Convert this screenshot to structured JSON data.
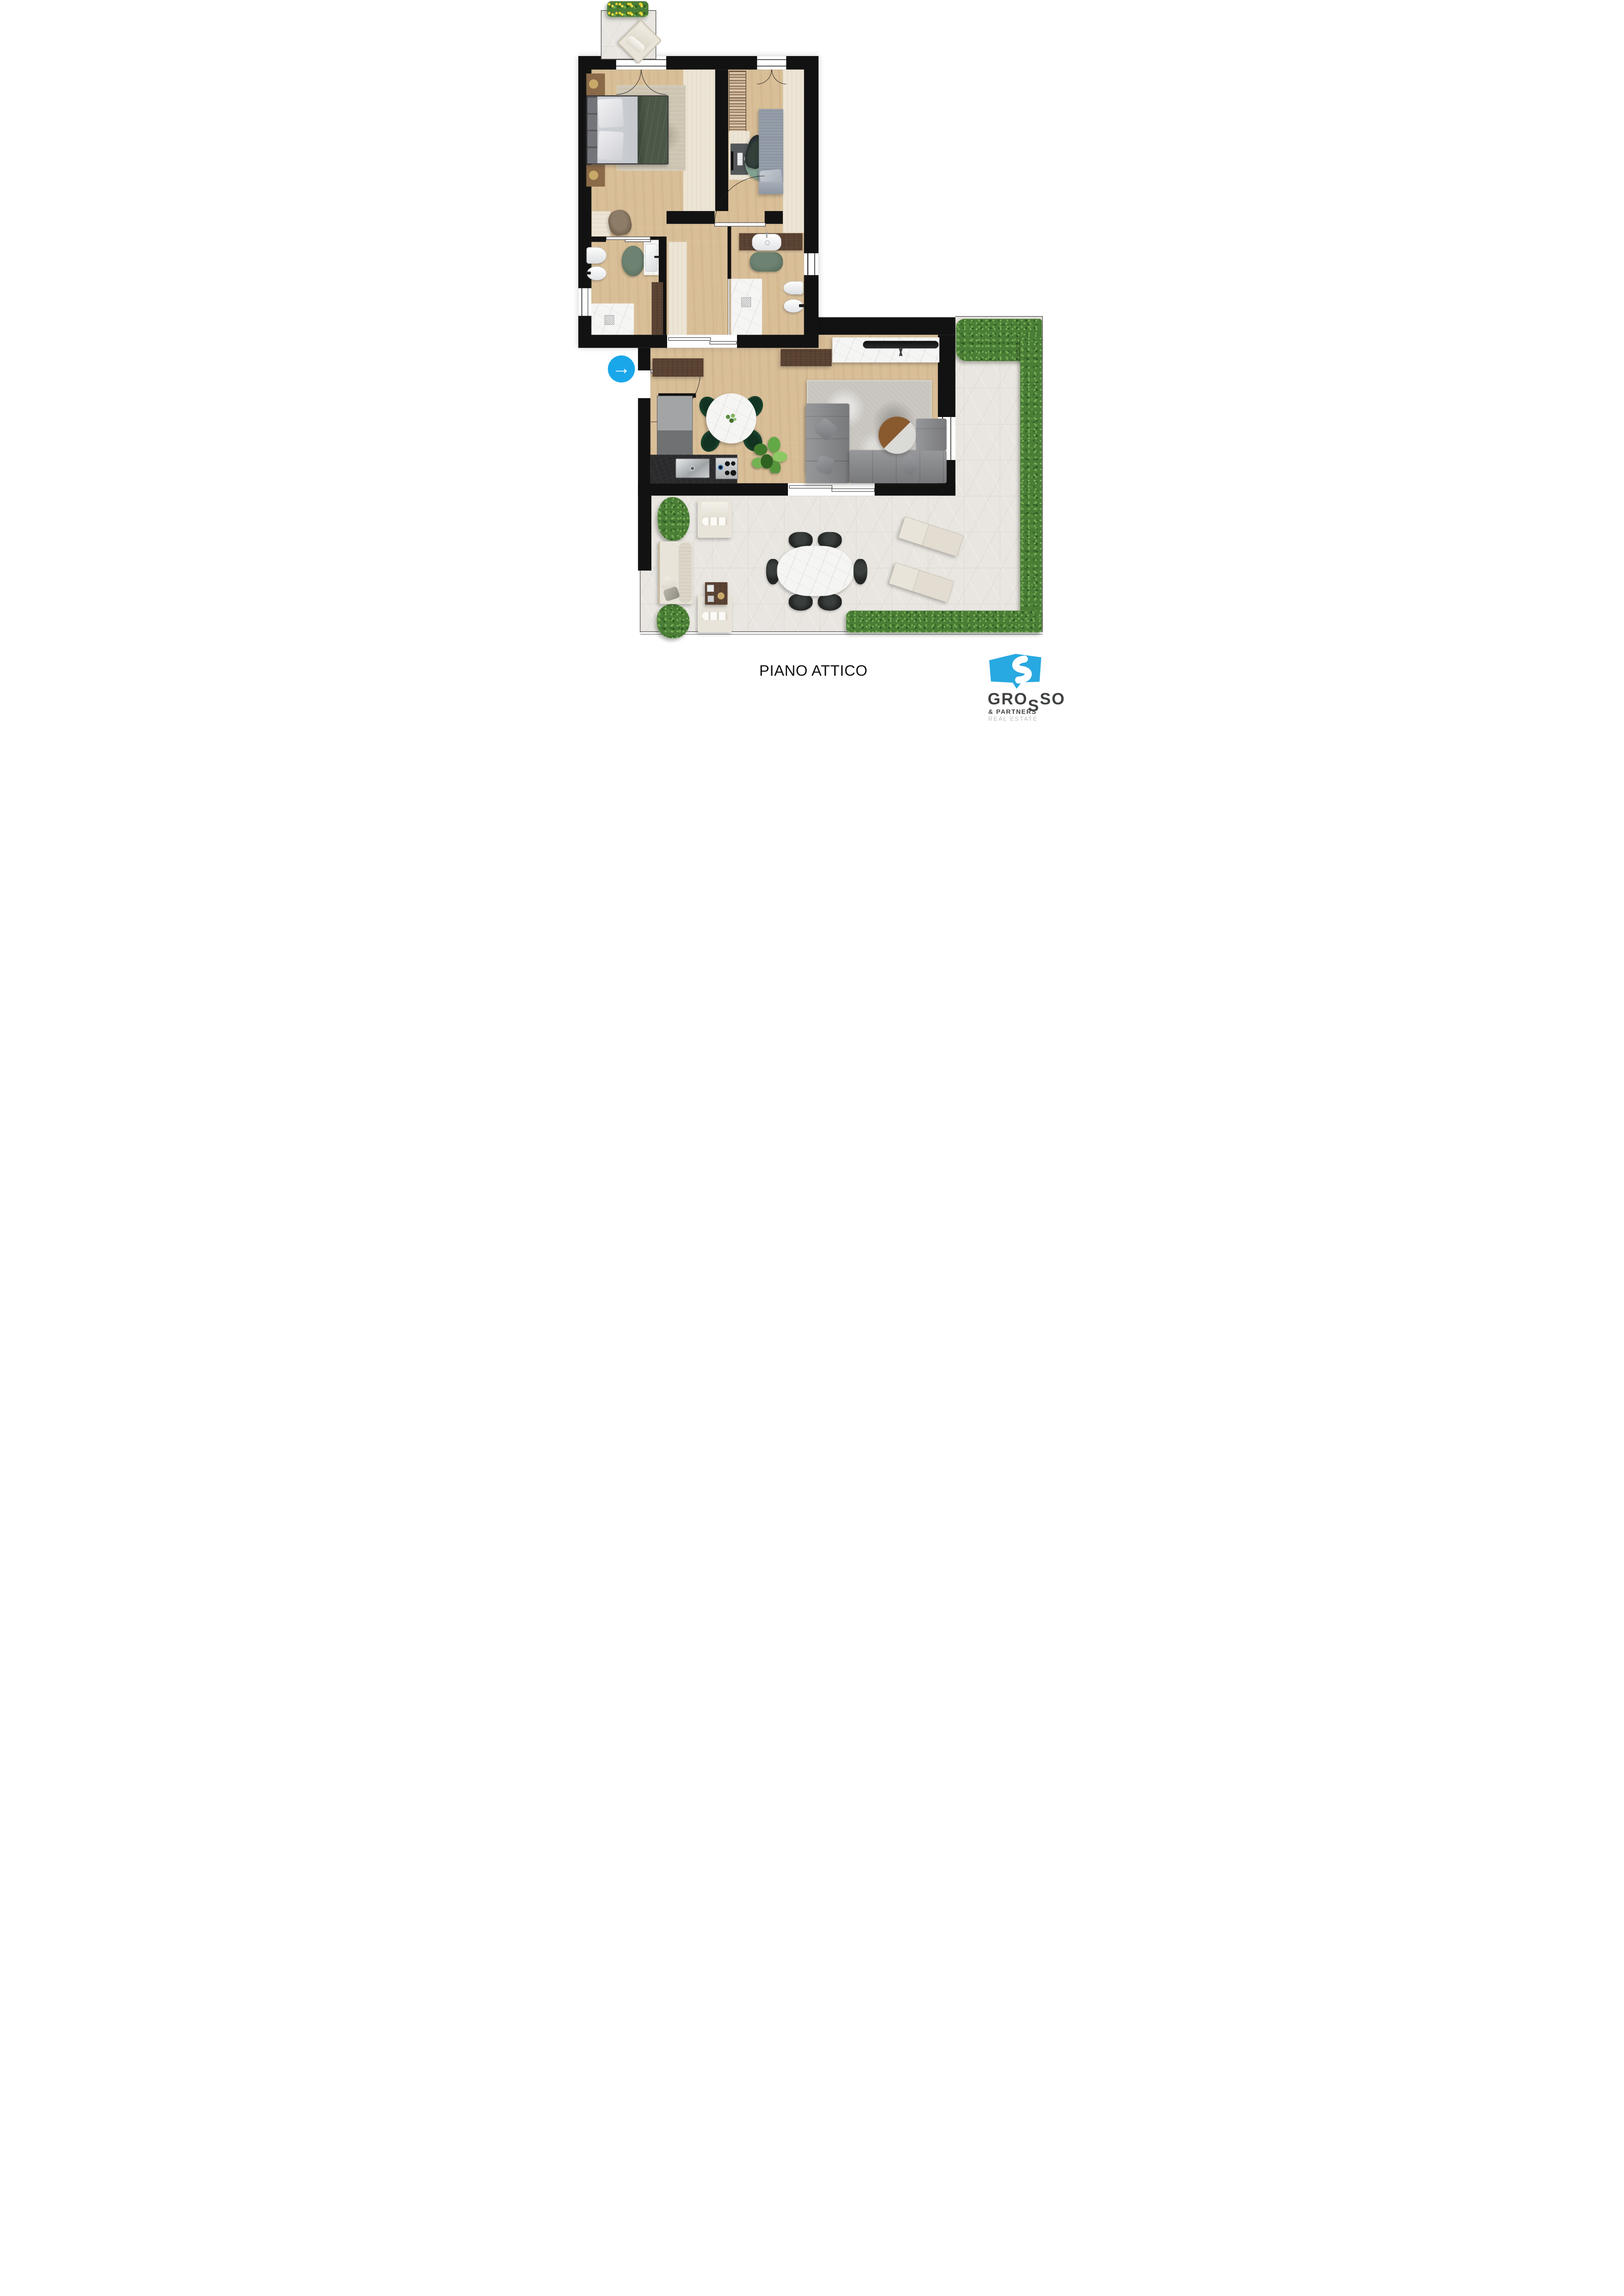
{
  "page": {
    "title": "PIANO ATTICO"
  },
  "logo": {
    "name_prefix": "GRO",
    "name_drop": "S",
    "name_suffix": "SO",
    "subtitle": "& PARTNERS",
    "tagline": "REAL ESTATE"
  },
  "entrance": {
    "icon": "arrow-right-circle",
    "glyph": "→"
  },
  "palette": {
    "wall": "#121212",
    "wood": "#d9bf98",
    "tile": "#e9e6e1",
    "tileline": "#dbd7d0",
    "wardrobe": "#ece4d4",
    "walnut": "#5a4232",
    "hedge": "#4a7d36",
    "marble": "#f5f5f3",
    "sofa": "#86878a",
    "rug_living": "#c8c5c0",
    "rug_bed": "#cdc4b1",
    "green_rug": "#5c7060",
    "teal_rug": "#7fa08f",
    "duvet": "#4b5848",
    "cream": "#e9e4d9",
    "black_chair": "#242726",
    "dining_chair": "#1e4a32",
    "counter": "#2a2a2c",
    "accent": "#1aa7ea",
    "brand_blue": "#29a9e1",
    "logo_dark": "#3f4142",
    "logo_light": "#bcbebf",
    "title_color": "#111111"
  }
}
